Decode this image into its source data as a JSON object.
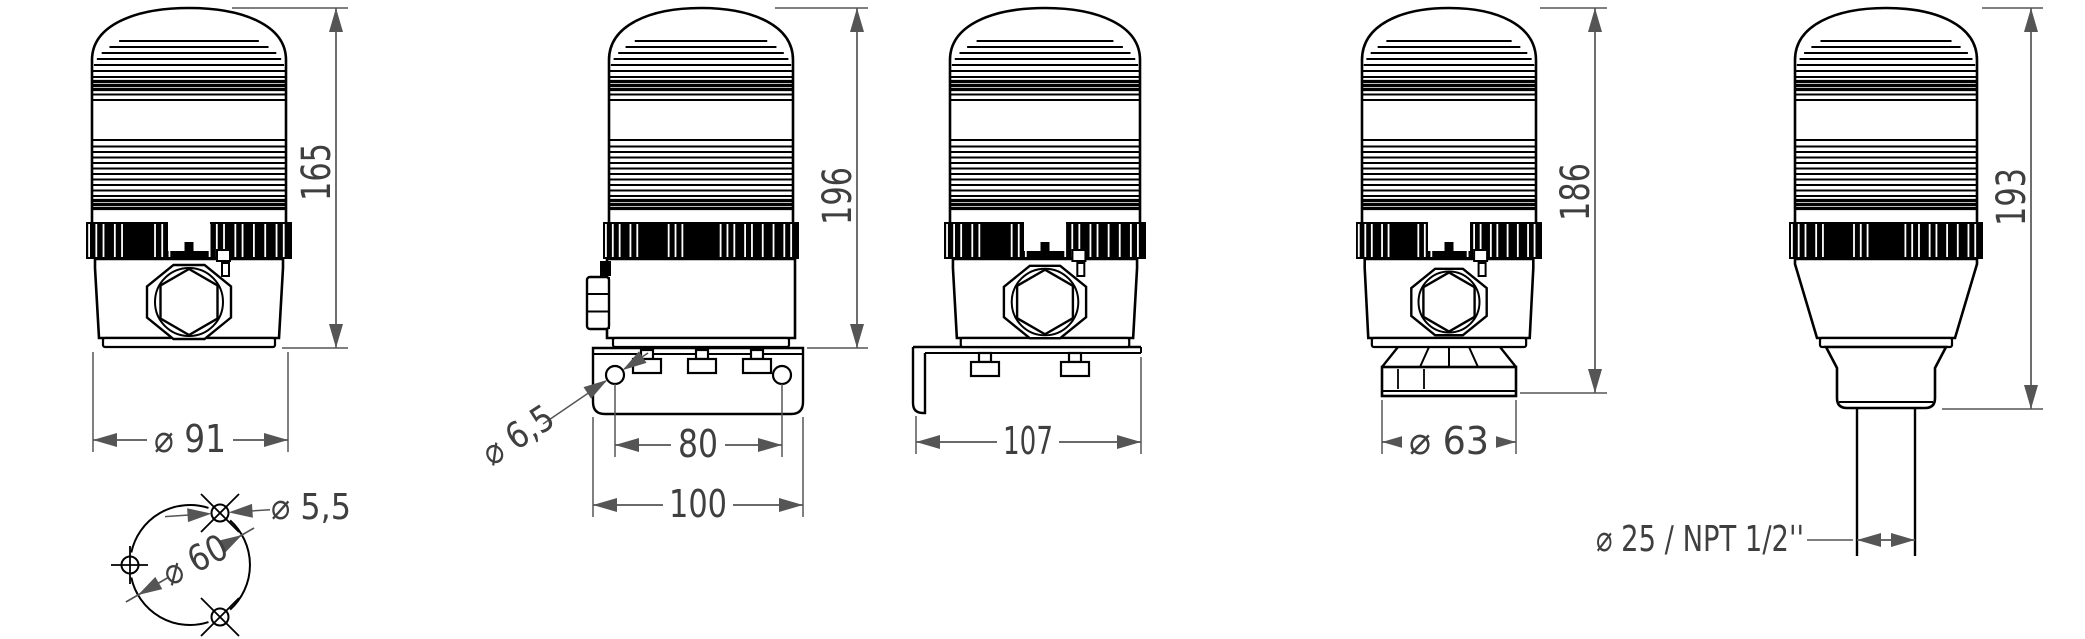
{
  "drawing": {
    "background": "#ffffff",
    "line_color": "#000000",
    "dimension_color": "#555555",
    "text_color": "#3f3f3f",
    "figures": [
      {
        "name": "beacon-front-view-base-mount",
        "dimensions": {
          "height": "165",
          "base_diameter": "⌀ 91",
          "mounting_hole_diameter": "⌀ 5,5",
          "bolt_circle_diameter": "⌀ 60"
        }
      },
      {
        "name": "beacon-side-view-wall-bracket",
        "dimensions": {
          "height": "196",
          "bracket_hole_diameter": "⌀ 6,5",
          "hole_spacing": "80",
          "bracket_width": "100"
        }
      },
      {
        "name": "beacon-front-view-wall-bracket",
        "dimensions": {
          "depth": "107"
        }
      },
      {
        "name": "beacon-front-view-pipe-adapter",
        "dimensions": {
          "height": "186",
          "adapter_diameter": "⌀ 63"
        }
      },
      {
        "name": "beacon-side-view-tube-mount",
        "dimensions": {
          "height": "193",
          "tube_spec": "⌀ 25 / NPT 1/2''"
        }
      }
    ]
  }
}
